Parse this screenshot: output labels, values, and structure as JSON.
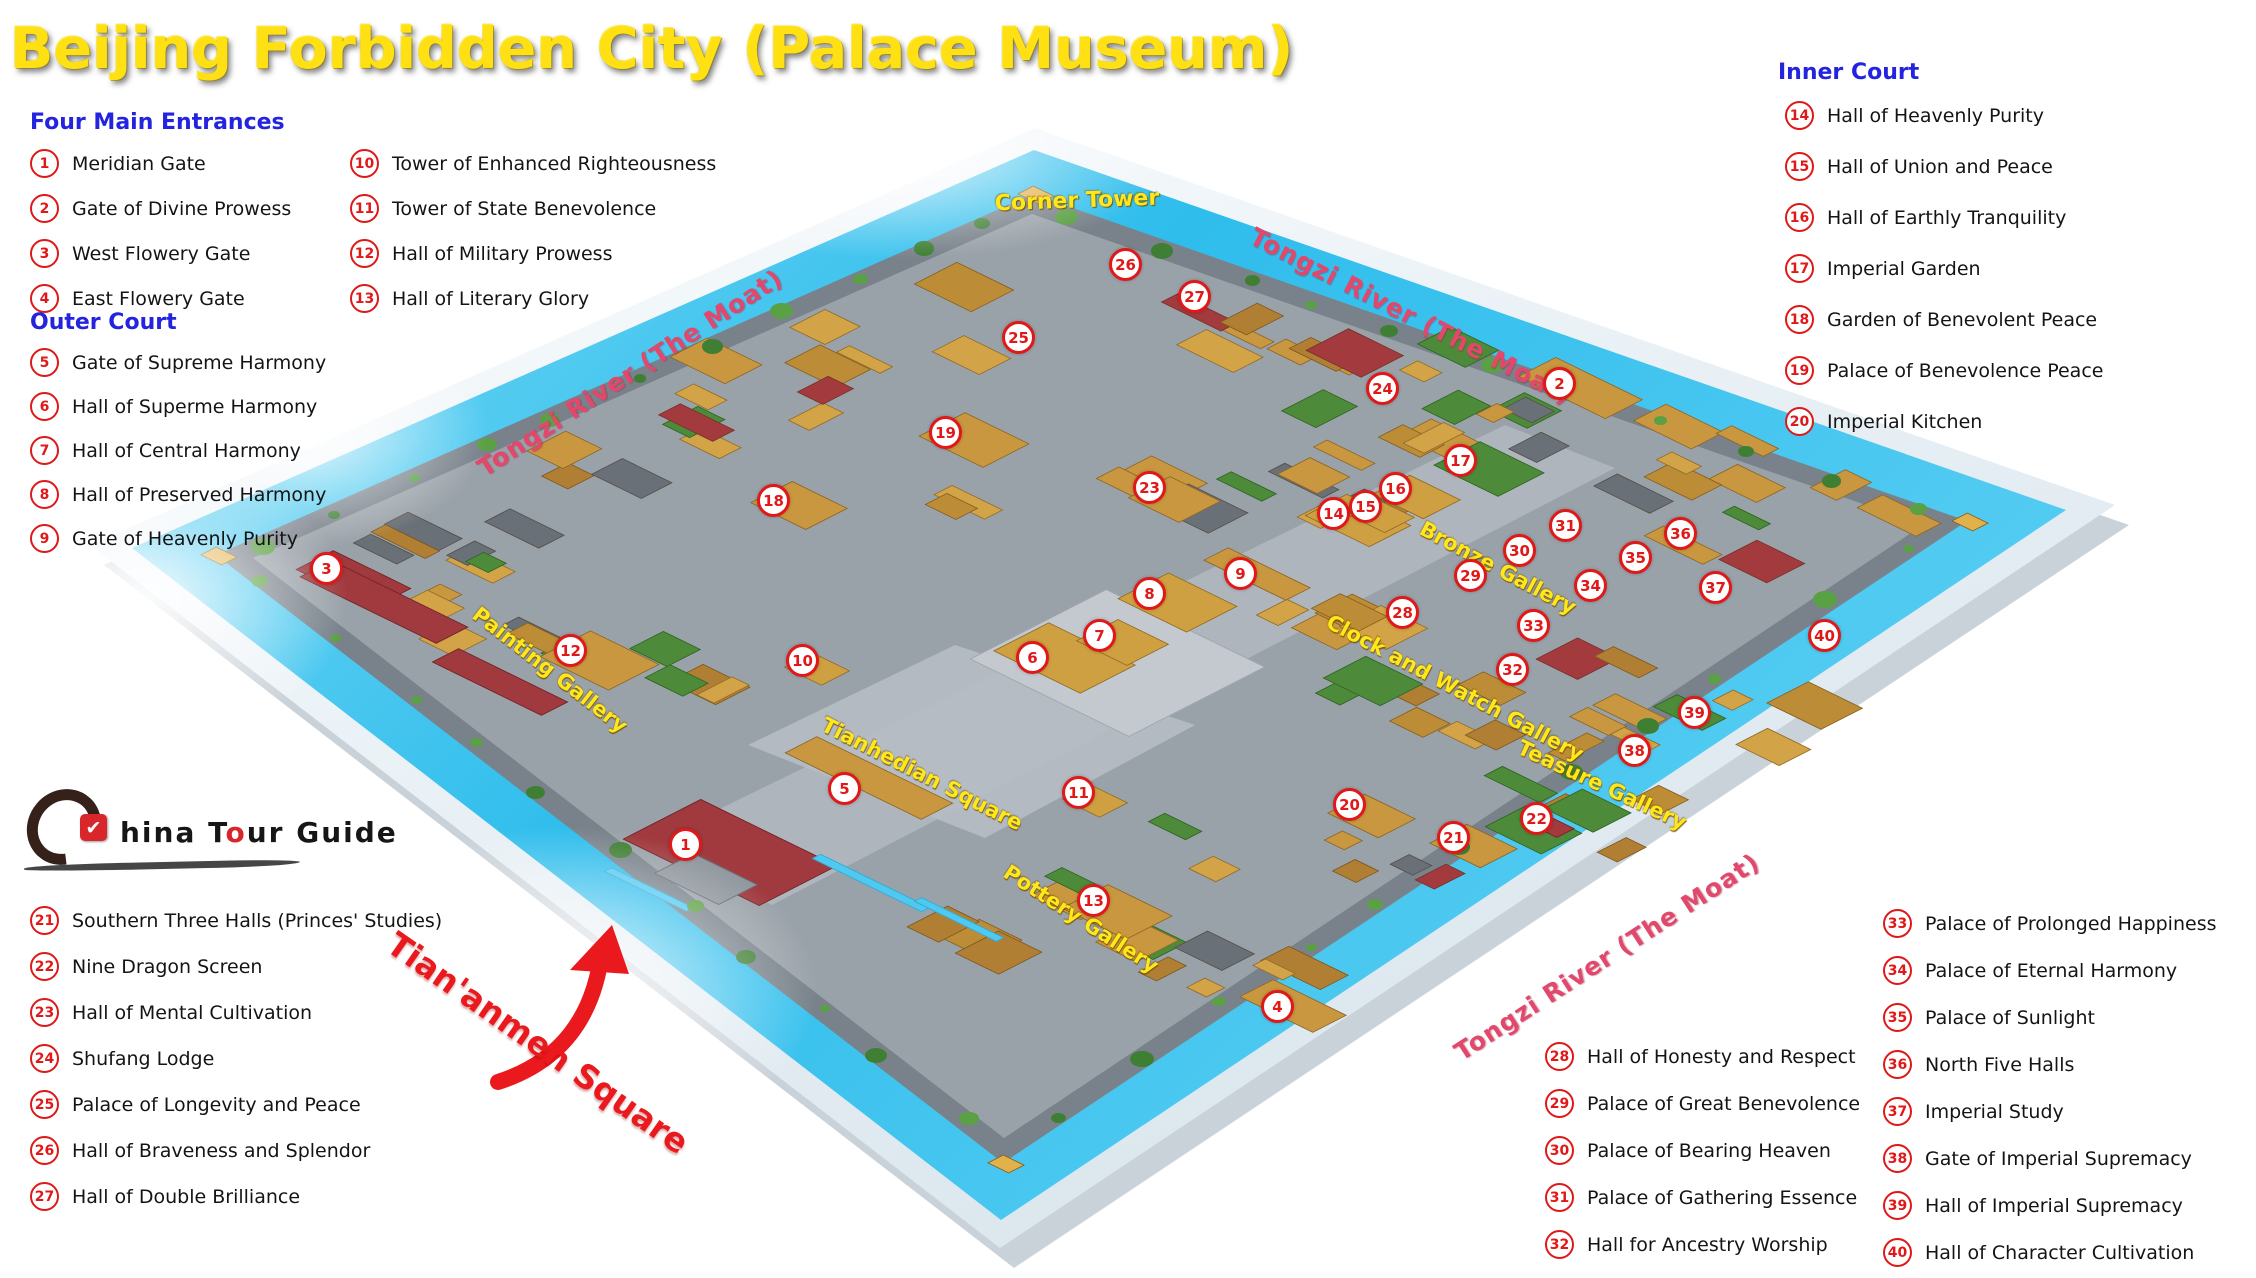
{
  "title": "Beijing Forbidden City (Palace Museum)",
  "legend": {
    "four_main_entrances_heading": "Four Main Entrances",
    "outer_court_heading": "Outer Court",
    "inner_court_heading": "Inner Court",
    "entrances": [
      {
        "num": "1",
        "label": "Meridian Gate"
      },
      {
        "num": "2",
        "label": "Gate of Divine Prowess"
      },
      {
        "num": "3",
        "label": "West Flowery Gate"
      },
      {
        "num": "4",
        "label": "East Flowery Gate"
      }
    ],
    "towers": [
      {
        "num": "10",
        "label": "Tower of Enhanced Righteousness"
      },
      {
        "num": "11",
        "label": "Tower of State Benevolence"
      },
      {
        "num": "12",
        "label": "Hall of Military Prowess"
      },
      {
        "num": "13",
        "label": "Hall of  Literary Glory"
      }
    ],
    "outer_court": [
      {
        "num": "5",
        "label": "Gate of Supreme Harmony"
      },
      {
        "num": "6",
        "label": "Hall of Superme Harmony"
      },
      {
        "num": "7",
        "label": "Hall of Central Harmony"
      },
      {
        "num": "8",
        "label": "Hall of Preserved Harmony"
      },
      {
        "num": "9",
        "label": "Gate of Heavenly Purity"
      }
    ],
    "inner_court": [
      {
        "num": "14",
        "label": "Hall of Heavenly Purity"
      },
      {
        "num": "15",
        "label": "Hall of Union and Peace"
      },
      {
        "num": "16",
        "label": "Hall of Earthly Tranquility"
      },
      {
        "num": "17",
        "label": "Imperial Garden"
      },
      {
        "num": "18",
        "label": "Garden of Benevolent Peace"
      },
      {
        "num": "19",
        "label": "Palace of Benevolence Peace"
      },
      {
        "num": "20",
        "label": "Imperial Kitchen"
      }
    ],
    "southwest": [
      {
        "num": "21",
        "label": "Southern Three Halls (Princes' Studies)"
      },
      {
        "num": "22",
        "label": "Nine Dragon Screen"
      },
      {
        "num": "23",
        "label": "Hall of Mental Cultivation"
      },
      {
        "num": "24",
        "label": "Shufang Lodge"
      },
      {
        "num": "25",
        "label": "Palace of Longevity and Peace"
      },
      {
        "num": "26",
        "label": "Hall of Braveness and Splendor"
      },
      {
        "num": "27",
        "label": "Hall of Double Brilliance"
      }
    ],
    "southeast_a": [
      {
        "num": "28",
        "label": "Hall of Honesty and Respect"
      },
      {
        "num": "29",
        "label": "Palace of Great Benevolence"
      },
      {
        "num": "30",
        "label": "Palace of Bearing Heaven"
      },
      {
        "num": "31",
        "label": "Palace of Gathering Essence"
      },
      {
        "num": "32",
        "label": "Hall for Ancestry Worship"
      }
    ],
    "southeast_b": [
      {
        "num": "33",
        "label": "Palace of Prolonged Happiness"
      },
      {
        "num": "34",
        "label": "Palace of Eternal Harmony"
      },
      {
        "num": "35",
        "label": "Palace of Sunlight"
      },
      {
        "num": "36",
        "label": "North Five Halls"
      },
      {
        "num": "37",
        "label": "Imperial Study"
      },
      {
        "num": "38",
        "label": "Gate of Imperial Supremacy"
      },
      {
        "num": "39",
        "label": "Hall of Imperial Supremacy"
      },
      {
        "num": "40",
        "label": "Hall of Character Cultivation"
      }
    ]
  },
  "map_labels": [
    {
      "text": "Corner Tower",
      "x": 1077,
      "y": 201,
      "rot": -2,
      "kind": "place",
      "big": true
    },
    {
      "text": "Tongzi River (The Moat)",
      "x": 630,
      "y": 373,
      "rot": -33,
      "kind": "moat"
    },
    {
      "text": "Tongzi River (The Moat)",
      "x": 1411,
      "y": 316,
      "rot": 27,
      "kind": "moat"
    },
    {
      "text": "Tongzi River (The Moat)",
      "x": 1607,
      "y": 957,
      "rot": -33,
      "kind": "moat"
    },
    {
      "text": "Painting Gallery",
      "x": 550,
      "y": 670,
      "rot": 38,
      "kind": "place"
    },
    {
      "text": "Tianhedian Square",
      "x": 922,
      "y": 774,
      "rot": 27,
      "kind": "place"
    },
    {
      "text": "Bronze Gallery",
      "x": 1498,
      "y": 568,
      "rot": 28,
      "kind": "place"
    },
    {
      "text": "Clock and Watch Gallery",
      "x": 1455,
      "y": 688,
      "rot": 28,
      "kind": "place"
    },
    {
      "text": "Teasure Gallery",
      "x": 1602,
      "y": 785,
      "rot": 25,
      "kind": "place"
    },
    {
      "text": "Pottery Gallery",
      "x": 1081,
      "y": 919,
      "rot": 33,
      "kind": "place"
    }
  ],
  "markers": [
    {
      "n": "1",
      "x": 683,
      "y": 842
    },
    {
      "n": "2",
      "x": 1557,
      "y": 381
    },
    {
      "n": "3",
      "x": 324,
      "y": 566
    },
    {
      "n": "4",
      "x": 1275,
      "y": 1004
    },
    {
      "n": "5",
      "x": 842,
      "y": 786
    },
    {
      "n": "6",
      "x": 1030,
      "y": 655
    },
    {
      "n": "7",
      "x": 1097,
      "y": 633
    },
    {
      "n": "8",
      "x": 1147,
      "y": 591
    },
    {
      "n": "9",
      "x": 1238,
      "y": 571
    },
    {
      "n": "10",
      "x": 800,
      "y": 658
    },
    {
      "n": "11",
      "x": 1076,
      "y": 790
    },
    {
      "n": "12",
      "x": 568,
      "y": 648
    },
    {
      "n": "13",
      "x": 1091,
      "y": 898
    },
    {
      "n": "14",
      "x": 1331,
      "y": 511
    },
    {
      "n": "15",
      "x": 1363,
      "y": 504
    },
    {
      "n": "16",
      "x": 1393,
      "y": 486
    },
    {
      "n": "17",
      "x": 1458,
      "y": 458
    },
    {
      "n": "18",
      "x": 771,
      "y": 498
    },
    {
      "n": "19",
      "x": 943,
      "y": 430
    },
    {
      "n": "20",
      "x": 1347,
      "y": 802
    },
    {
      "n": "21",
      "x": 1451,
      "y": 835
    },
    {
      "n": "22",
      "x": 1534,
      "y": 816
    },
    {
      "n": "23",
      "x": 1147,
      "y": 485
    },
    {
      "n": "24",
      "x": 1380,
      "y": 386
    },
    {
      "n": "25",
      "x": 1016,
      "y": 335
    },
    {
      "n": "26",
      "x": 1123,
      "y": 262
    },
    {
      "n": "27",
      "x": 1192,
      "y": 294
    },
    {
      "n": "28",
      "x": 1400,
      "y": 610
    },
    {
      "n": "29",
      "x": 1468,
      "y": 573
    },
    {
      "n": "30",
      "x": 1517,
      "y": 548
    },
    {
      "n": "31",
      "x": 1563,
      "y": 523
    },
    {
      "n": "32",
      "x": 1510,
      "y": 667
    },
    {
      "n": "33",
      "x": 1531,
      "y": 623
    },
    {
      "n": "34",
      "x": 1588,
      "y": 583
    },
    {
      "n": "35",
      "x": 1633,
      "y": 555
    },
    {
      "n": "36",
      "x": 1678,
      "y": 531
    },
    {
      "n": "37",
      "x": 1713,
      "y": 585
    },
    {
      "n": "38",
      "x": 1632,
      "y": 748
    },
    {
      "n": "39",
      "x": 1692,
      "y": 710
    },
    {
      "n": "40",
      "x": 1822,
      "y": 633
    }
  ],
  "annotation": {
    "text": "Tian'anmen Square"
  },
  "logo": {
    "checkmark": "✔",
    "text_before_o": "hina T",
    "o_letter": "o",
    "text_after_o": "ur Guide"
  },
  "colors": {
    "title_yellow": "#ffe113",
    "heading_blue": "#2424e0",
    "marker_red": "#e01818",
    "moat_cyan": "#2fbdec",
    "label_yellow": "#ffe71a",
    "moat_label_crimson": "#e2486b",
    "annotation_red": "#ea191e"
  }
}
